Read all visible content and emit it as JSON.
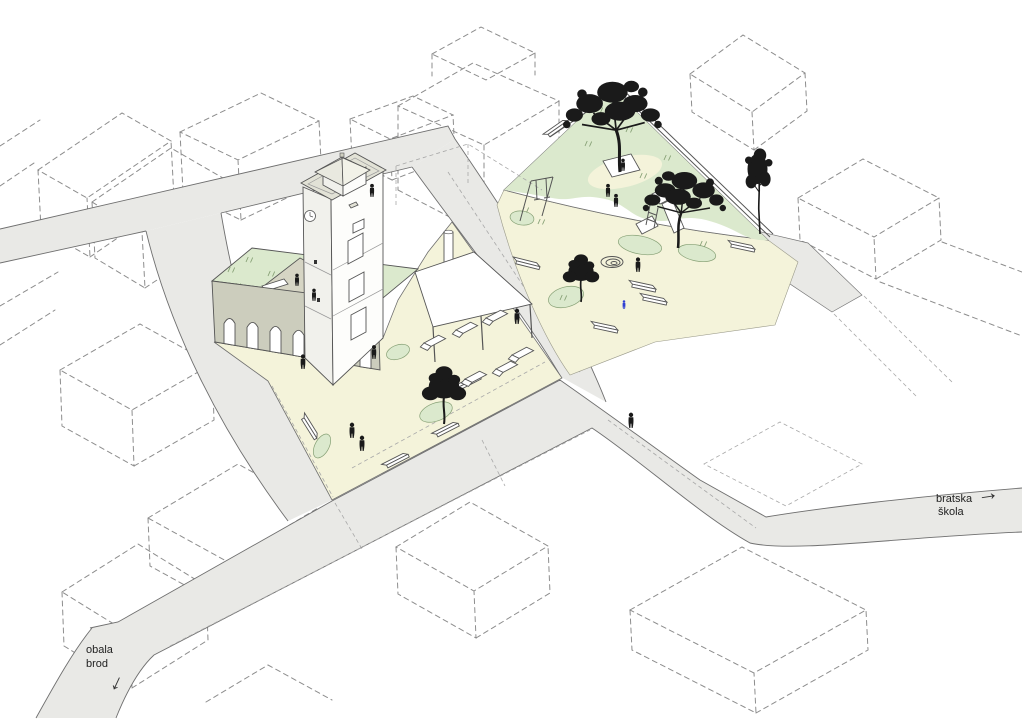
{
  "diagram": {
    "labels": {
      "street_east": {
        "line1": "bratska",
        "line2": "škola"
      },
      "street_southwest": {
        "line1": "obala",
        "line2": "brod"
      }
    },
    "icons": {
      "direction_arrow": "→"
    }
  },
  "colors": {
    "paper": "#ffffff",
    "street": "#e9e9e6",
    "street-edge": "#6f6f6f",
    "plaza": "#f4f3da",
    "lawn": "#dbe9cd",
    "lawn-edge": "#86a075",
    "roof-deck": "#d6d5c4",
    "wall-beige": "#cccdbd",
    "parapet": "#e2e2d6",
    "face-shade": "#f1f1ec",
    "outline": "#555555",
    "dashed": "#8d8d8d",
    "ink": "#1a1a1a",
    "accent-blue": "#2f3fd3"
  }
}
